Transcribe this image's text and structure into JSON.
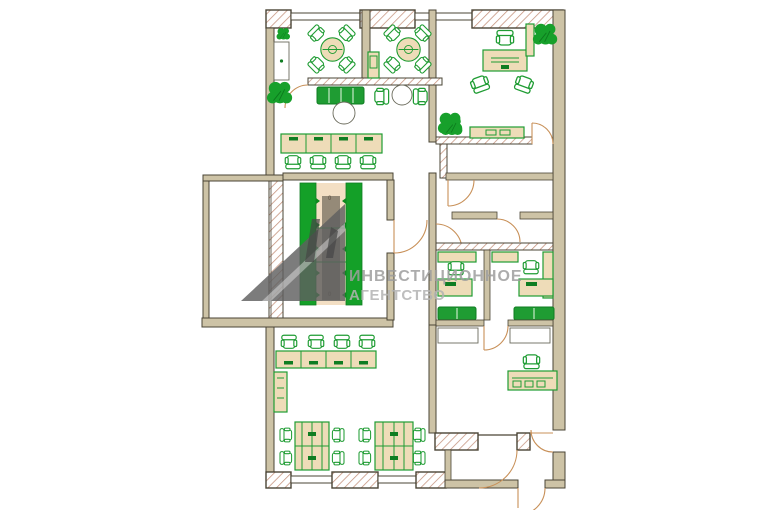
{
  "watermark": {
    "line1": "ИНВЕСТИЦИОННОЕ",
    "line2": "АГЕНТСТВО"
  },
  "marks": {
    "corridor_top": "0",
    "corridor_bottom": "0"
  },
  "colors": {
    "background": "#ffffff",
    "wall_fill": "#cdc3a6",
    "wall_stroke": "#4a4435",
    "hatch_line": "#c4917b",
    "furniture_green": "#1f9c33",
    "furniture_green_dark": "#0f7d22",
    "desk_fill": "#eedcb8",
    "plant_green": "#17a02b",
    "green_wall": "#14a028",
    "corridor_center": "#f3dfc4",
    "corridor_runner": "#8d8271",
    "door_arc": "#c89058",
    "watermark_text": "#9e9e9e",
    "watermark_text2": "#b3b3b3",
    "logo_gray": "#5f5f5f"
  }
}
